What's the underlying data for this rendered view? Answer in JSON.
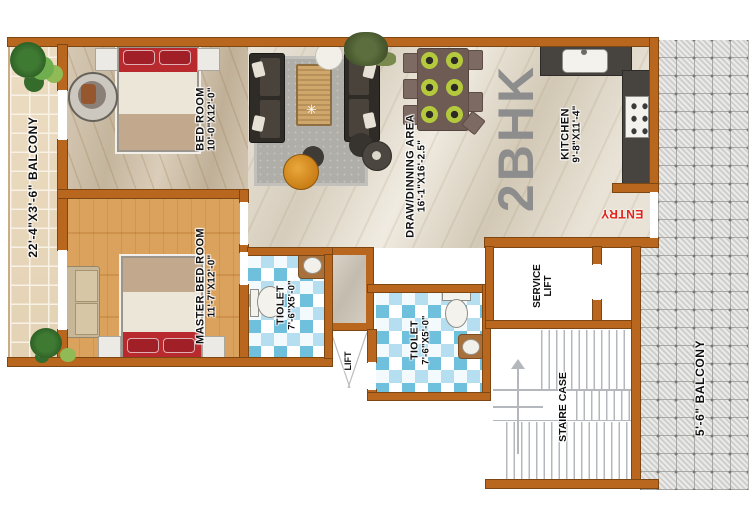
{
  "plan": {
    "type_label": "2BHK",
    "entry_label": "ENTRY",
    "decor": {
      "table_star": "✳"
    },
    "rooms": {
      "balcony_left": {
        "label": "22'-4\"X3'-6\" BALCONY"
      },
      "bedroom": {
        "name": "BED ROOM",
        "dims": "10'-0\"X12'-0\""
      },
      "master_bedroom": {
        "name": "MASTER BED ROOM",
        "dims": "11'-7\"X12'-0\""
      },
      "draw_dining": {
        "name": "DRAW/DINNING AREA",
        "dims": "16'-1\"X16'-2.5\""
      },
      "kitchen": {
        "name": "KITCHEN",
        "dims": "9'-8\"X11'-4\""
      },
      "toilet_1": {
        "name": "TIOLET",
        "dims": "7'-6\"X5'-0\""
      },
      "toilet_2": {
        "name": "TIOLET",
        "dims": "7'-6\"X5'-0\""
      },
      "lift": {
        "label": "LIFT"
      },
      "service_lift": {
        "line1": "SERVICE",
        "line2": "LIFT"
      },
      "staircase": {
        "label": "STAIRE CASE"
      },
      "balcony_right": {
        "label": "5'-6\" BALCONY"
      }
    },
    "colors": {
      "wall": "#b9671e",
      "entry_text": "#e02318",
      "type_text": "#8d8d8d",
      "toilet_tile_blue": "#6fc0dd",
      "wood_floor": "#d89b52",
      "counter_dark": "#474440",
      "bed_accent_red": "#b92a2e"
    }
  }
}
